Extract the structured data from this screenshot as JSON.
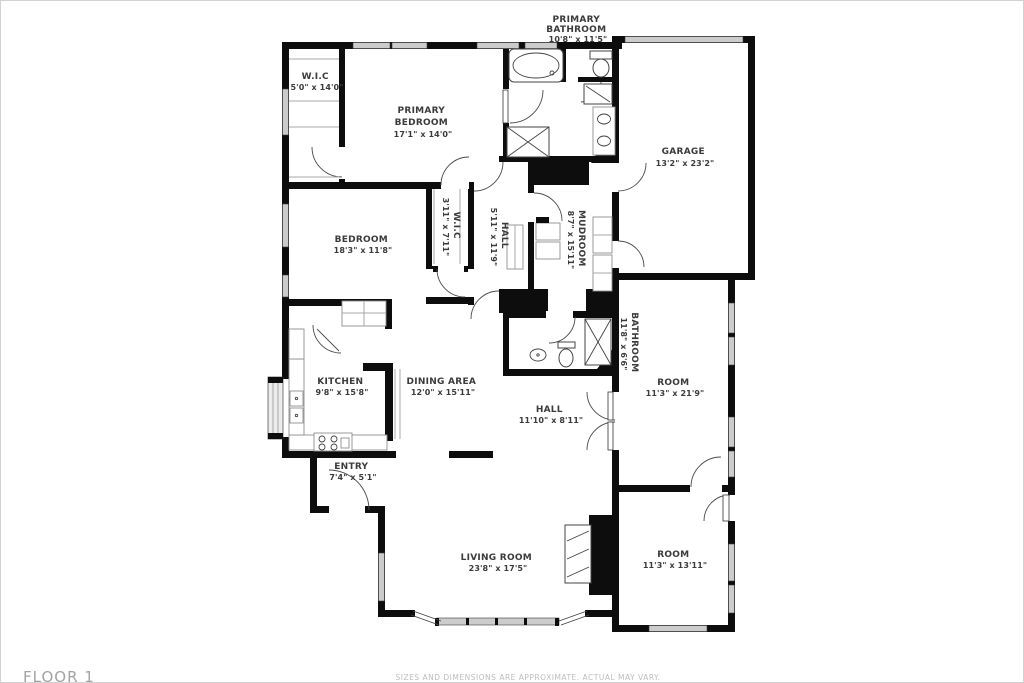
{
  "page": {
    "floor_label": "FLOOR 1",
    "disclaimer": "SIZES AND DIMENSIONS ARE APPROXIMATE. ACTUAL MAY VARY."
  },
  "colors": {
    "wall": "#0d0d0d",
    "window": "#cccccc",
    "label": "#3b3b3b",
    "muted": "#a3a3a3"
  },
  "rooms": {
    "primary_bathroom": {
      "line1": "PRIMARY",
      "line2": "BATHROOM",
      "dims": "10'8\" x 11'5\""
    },
    "wic_primary": {
      "line1": "W.I.C",
      "dims": "5'0\" x 14'0\""
    },
    "primary_bedroom": {
      "line1": "PRIMARY",
      "line2": "BEDROOM",
      "dims": "17'1\" x 14'0\""
    },
    "garage": {
      "line1": "GARAGE",
      "dims": "13'2\" x 23'2\""
    },
    "bedroom": {
      "line1": "BEDROOM",
      "dims": "18'3\" x 11'8\""
    },
    "wic_small": {
      "line1": "W.I.C",
      "dims": "3'11\" x 7'11\""
    },
    "hall_upper": {
      "line1": "HALL",
      "dims": "5'11\" x 11'9\""
    },
    "mudroom": {
      "line1": "MUDROOM",
      "dims": "8'7\" x 15'11\""
    },
    "bathroom": {
      "line1": "BATHROOM",
      "dims": "11'8\" x 6'6\""
    },
    "room_right": {
      "line1": "ROOM",
      "dims": "11'3\" x 21'9\""
    },
    "kitchen": {
      "line1": "KITCHEN",
      "dims": "9'8\" x 15'8\""
    },
    "dining": {
      "line1": "DINING AREA",
      "dims": "12'0\" x 15'11\""
    },
    "hall_lower": {
      "line1": "HALL",
      "dims": "11'10\" x 8'11\""
    },
    "entry": {
      "line1": "ENTRY",
      "dims": "7'4\" x 5'1\""
    },
    "living": {
      "line1": "LIVING ROOM",
      "dims": "23'8\" x 17'5\""
    },
    "room_bottom": {
      "line1": "ROOM",
      "dims": "11'3\" x 13'11\""
    }
  }
}
